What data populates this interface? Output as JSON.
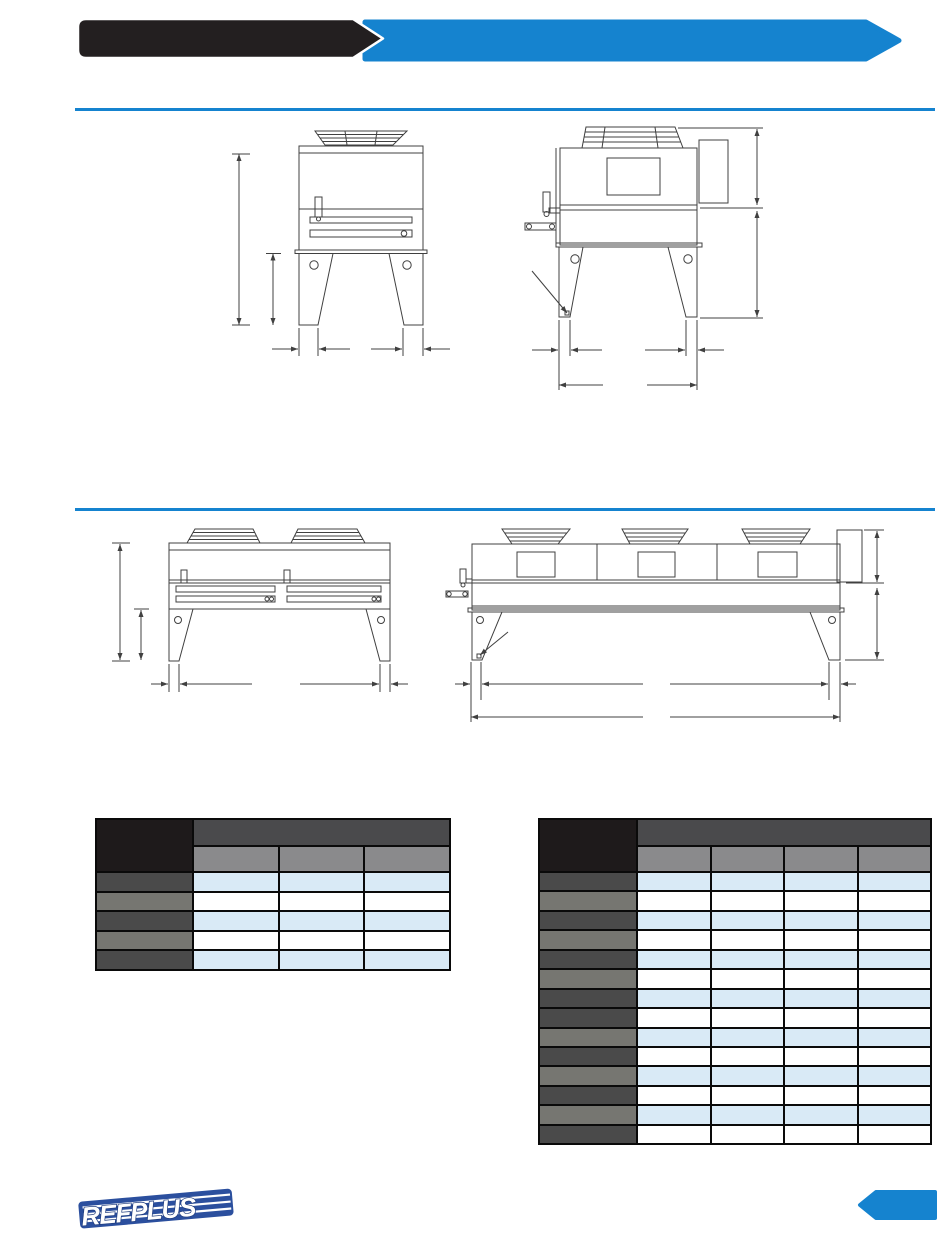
{
  "page": {
    "background": "#ffffff"
  },
  "header": {
    "black_banner": {
      "color": "#231f20"
    },
    "blue_banner": {
      "color": "#1583cf"
    }
  },
  "dividers": {
    "rule_color": "#1583cf"
  },
  "drawings": {
    "line_color": "#404040",
    "items": [
      {
        "name": "single-fan-unit-front-view"
      },
      {
        "name": "single-fan-unit-side-view"
      },
      {
        "name": "two-fan-unit-front-view"
      },
      {
        "name": "three-fan-unit-side-view"
      }
    ]
  },
  "tables": {
    "cell_colors": {
      "corner": "#1e1a1b",
      "group_header": "#4a4a4c",
      "sub_header": "#8a8a8c",
      "row_header_dark": "#4a4a4a",
      "row_header_medium": "#767671",
      "row_even": "#d9eaf6",
      "row_odd": "#ffffff"
    },
    "left": {
      "sub_columns": 3,
      "data_rows": 5,
      "row_header_pattern": [
        "dark",
        "medium",
        "dark",
        "medium",
        "dark"
      ]
    },
    "right": {
      "sub_columns": 4,
      "data_rows": 14,
      "row_header_pattern": [
        "dark",
        "medium",
        "dark",
        "medium",
        "dark",
        "medium",
        "dark",
        "dark",
        "medium",
        "dark",
        "medium",
        "dark",
        "medium",
        "dark"
      ]
    }
  },
  "footer": {
    "logo_text": "REFPLUS",
    "logo_blue": "#2b4f9e",
    "tag_color": "#1583cf"
  }
}
